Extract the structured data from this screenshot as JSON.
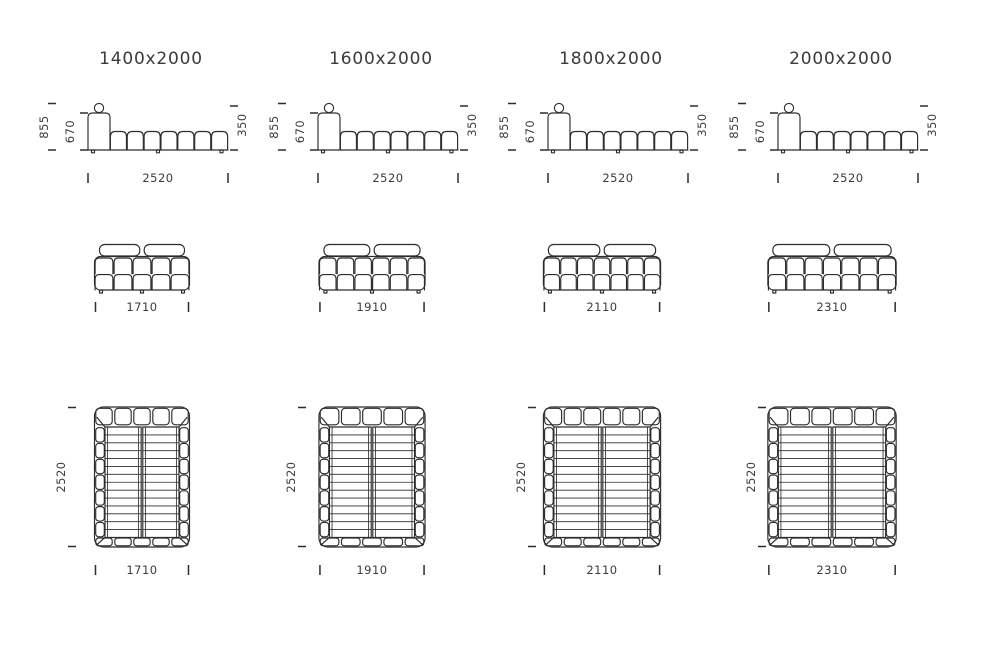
{
  "page": {
    "background": "#ffffff",
    "line_color": "#2c2c2c",
    "text_color": "#3b3b3b"
  },
  "shared_dims": {
    "total_height": "855",
    "backrest_height": "670",
    "seat_height": "350",
    "total_length": "2520",
    "total_depth": "2520"
  },
  "side_view": {
    "seat_bumps": 7
  },
  "top_view": {
    "mattress_slats": 13
  },
  "columns": [
    {
      "title": "1400x2000",
      "width_value": "1710",
      "front_cushion_columns": 5,
      "top_edge_cushions": 5,
      "side_edge_cushions": 7
    },
    {
      "title": "1600x2000",
      "width_value": "1910",
      "front_cushion_columns": 6,
      "top_edge_cushions": 5,
      "side_edge_cushions": 7
    },
    {
      "title": "1800x2000",
      "width_value": "2110",
      "front_cushion_columns": 7,
      "top_edge_cushions": 6,
      "side_edge_cushions": 7
    },
    {
      "title": "2000x2000",
      "width_value": "2310",
      "front_cushion_columns": 7,
      "top_edge_cushions": 6,
      "side_edge_cushions": 7
    }
  ]
}
